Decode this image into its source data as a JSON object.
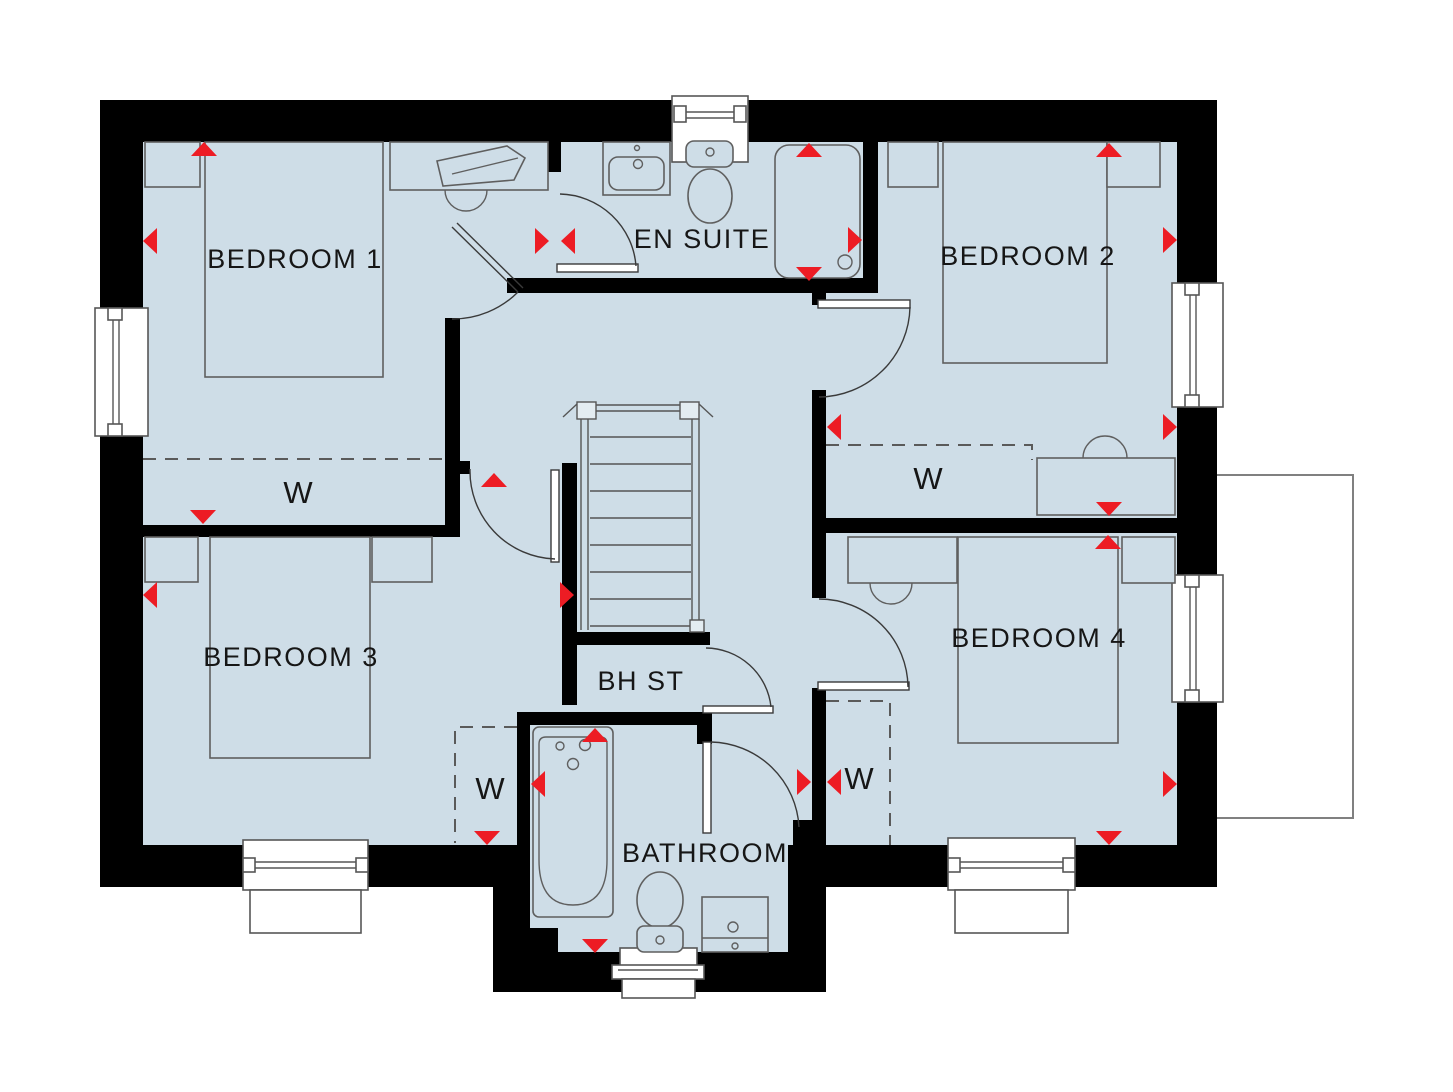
{
  "plan": {
    "type": "first-floor house floor plan",
    "rooms": {
      "bedroom1": "BEDROOM 1",
      "bedroom2": "BEDROOM 2",
      "bedroom3": "BEDROOM 3",
      "bedroom4": "BEDROOM 4",
      "ensuite": "EN SUITE",
      "bathroom": "BATHROOM",
      "bulkhead_store": "BH ST",
      "wardrobe1": "W",
      "wardrobe2": "W",
      "wardrobe3": "W",
      "wardrobe4": "W"
    }
  },
  "colors": {
    "floor": "#cedde7",
    "wall": "#000000",
    "marker_red": "#ed1c24",
    "window_frame": "#ffffff",
    "external_outline": "#808080"
  }
}
